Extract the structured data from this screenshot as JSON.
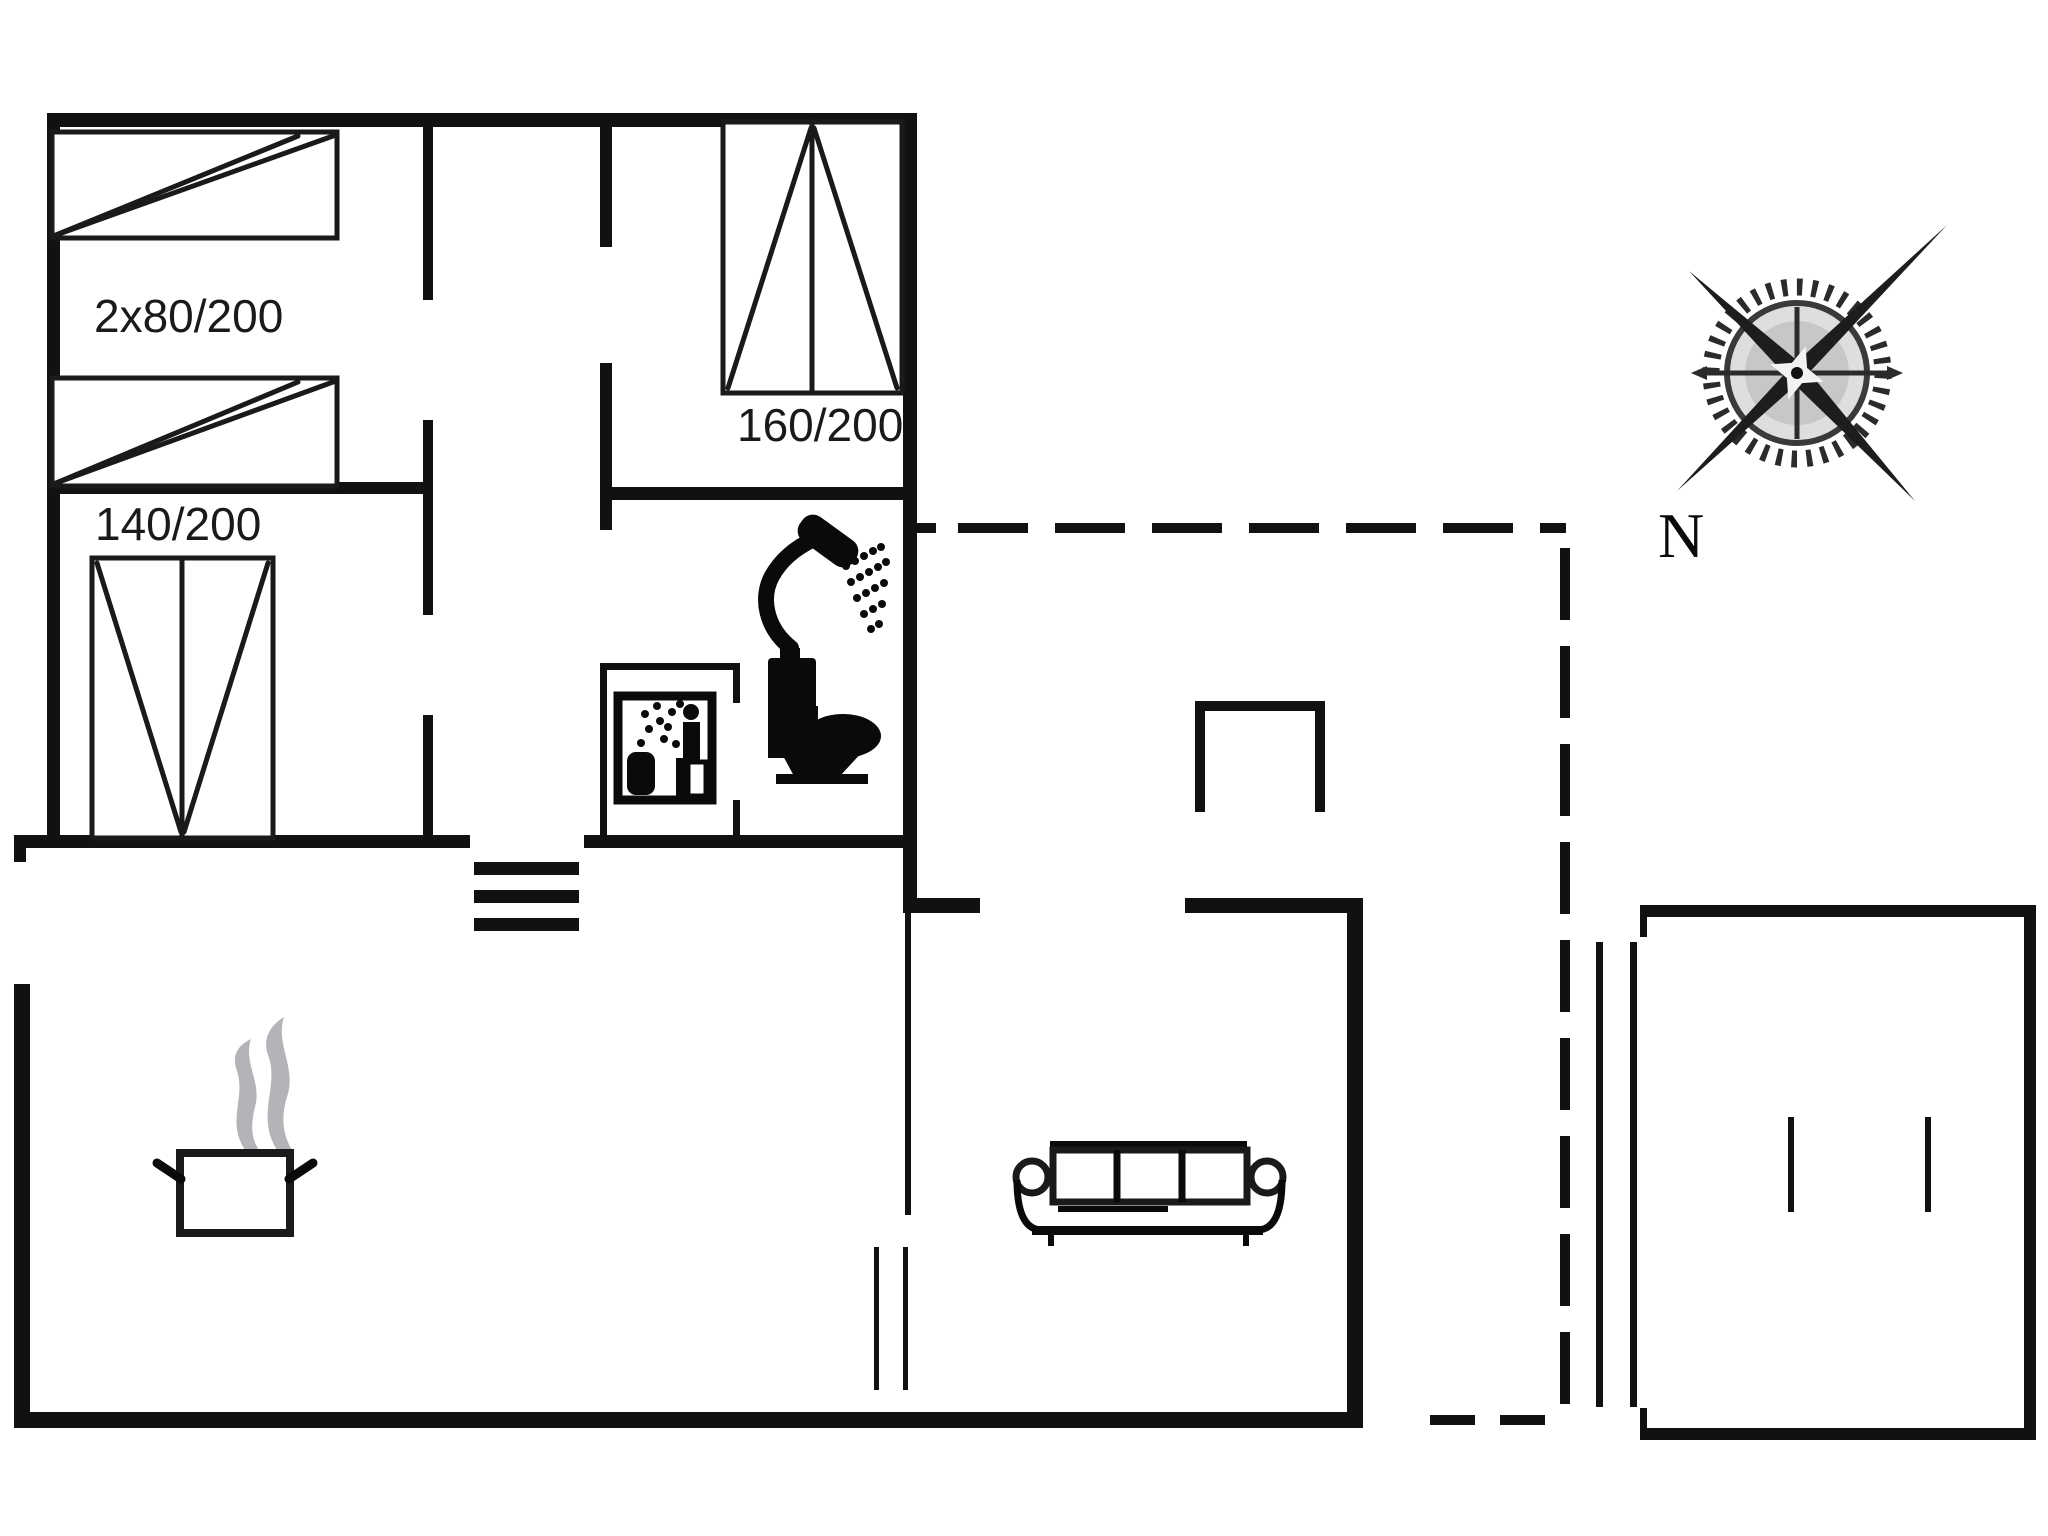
{
  "diagram": {
    "type": "floor-plan",
    "labels": {
      "bed_2x80": "2x80/200",
      "bed_140": "140/200",
      "bed_160": "160/200",
      "north": "N"
    },
    "icons": {
      "compass": "compass-rose-icon",
      "pot": "cooking-pot-steam-icon",
      "sofa": "sofa-icon",
      "shower": "shower-icon",
      "toilet": "toilet-icon",
      "sauna": "sauna-pictogram-icon",
      "steps": "entrance-steps-icon"
    },
    "colors": {
      "wall": "#111111",
      "line": "#1a1a1a",
      "icon": "#0a0a0a",
      "steam": "#b3b3b8",
      "background": "#ffffff",
      "compass": "#2b2b2b"
    }
  }
}
